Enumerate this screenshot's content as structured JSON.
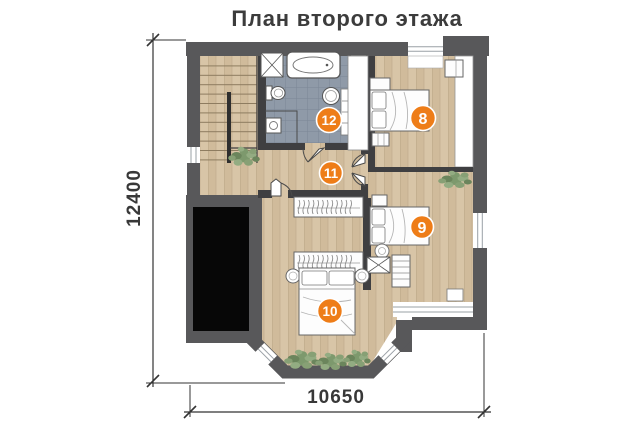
{
  "title": "План второго этажа",
  "dimensions": {
    "height_label": "12400",
    "width_label": "10650"
  },
  "room_markers": {
    "bedroom_top": "8",
    "bedroom_middle": "9",
    "bedroom_bottom": "10",
    "hallway": "11",
    "bathroom": "12"
  },
  "colors": {
    "accent_orange": "#ee7d18",
    "wall_gray": "#58585a",
    "partition_dark": "#3f3f41",
    "wood_floor": "#d8c5a7",
    "bath_tile": "#8f9aa8",
    "plant_green": "#7d996d",
    "text_dark": "#3c3c3c",
    "void_black": "#070707"
  }
}
